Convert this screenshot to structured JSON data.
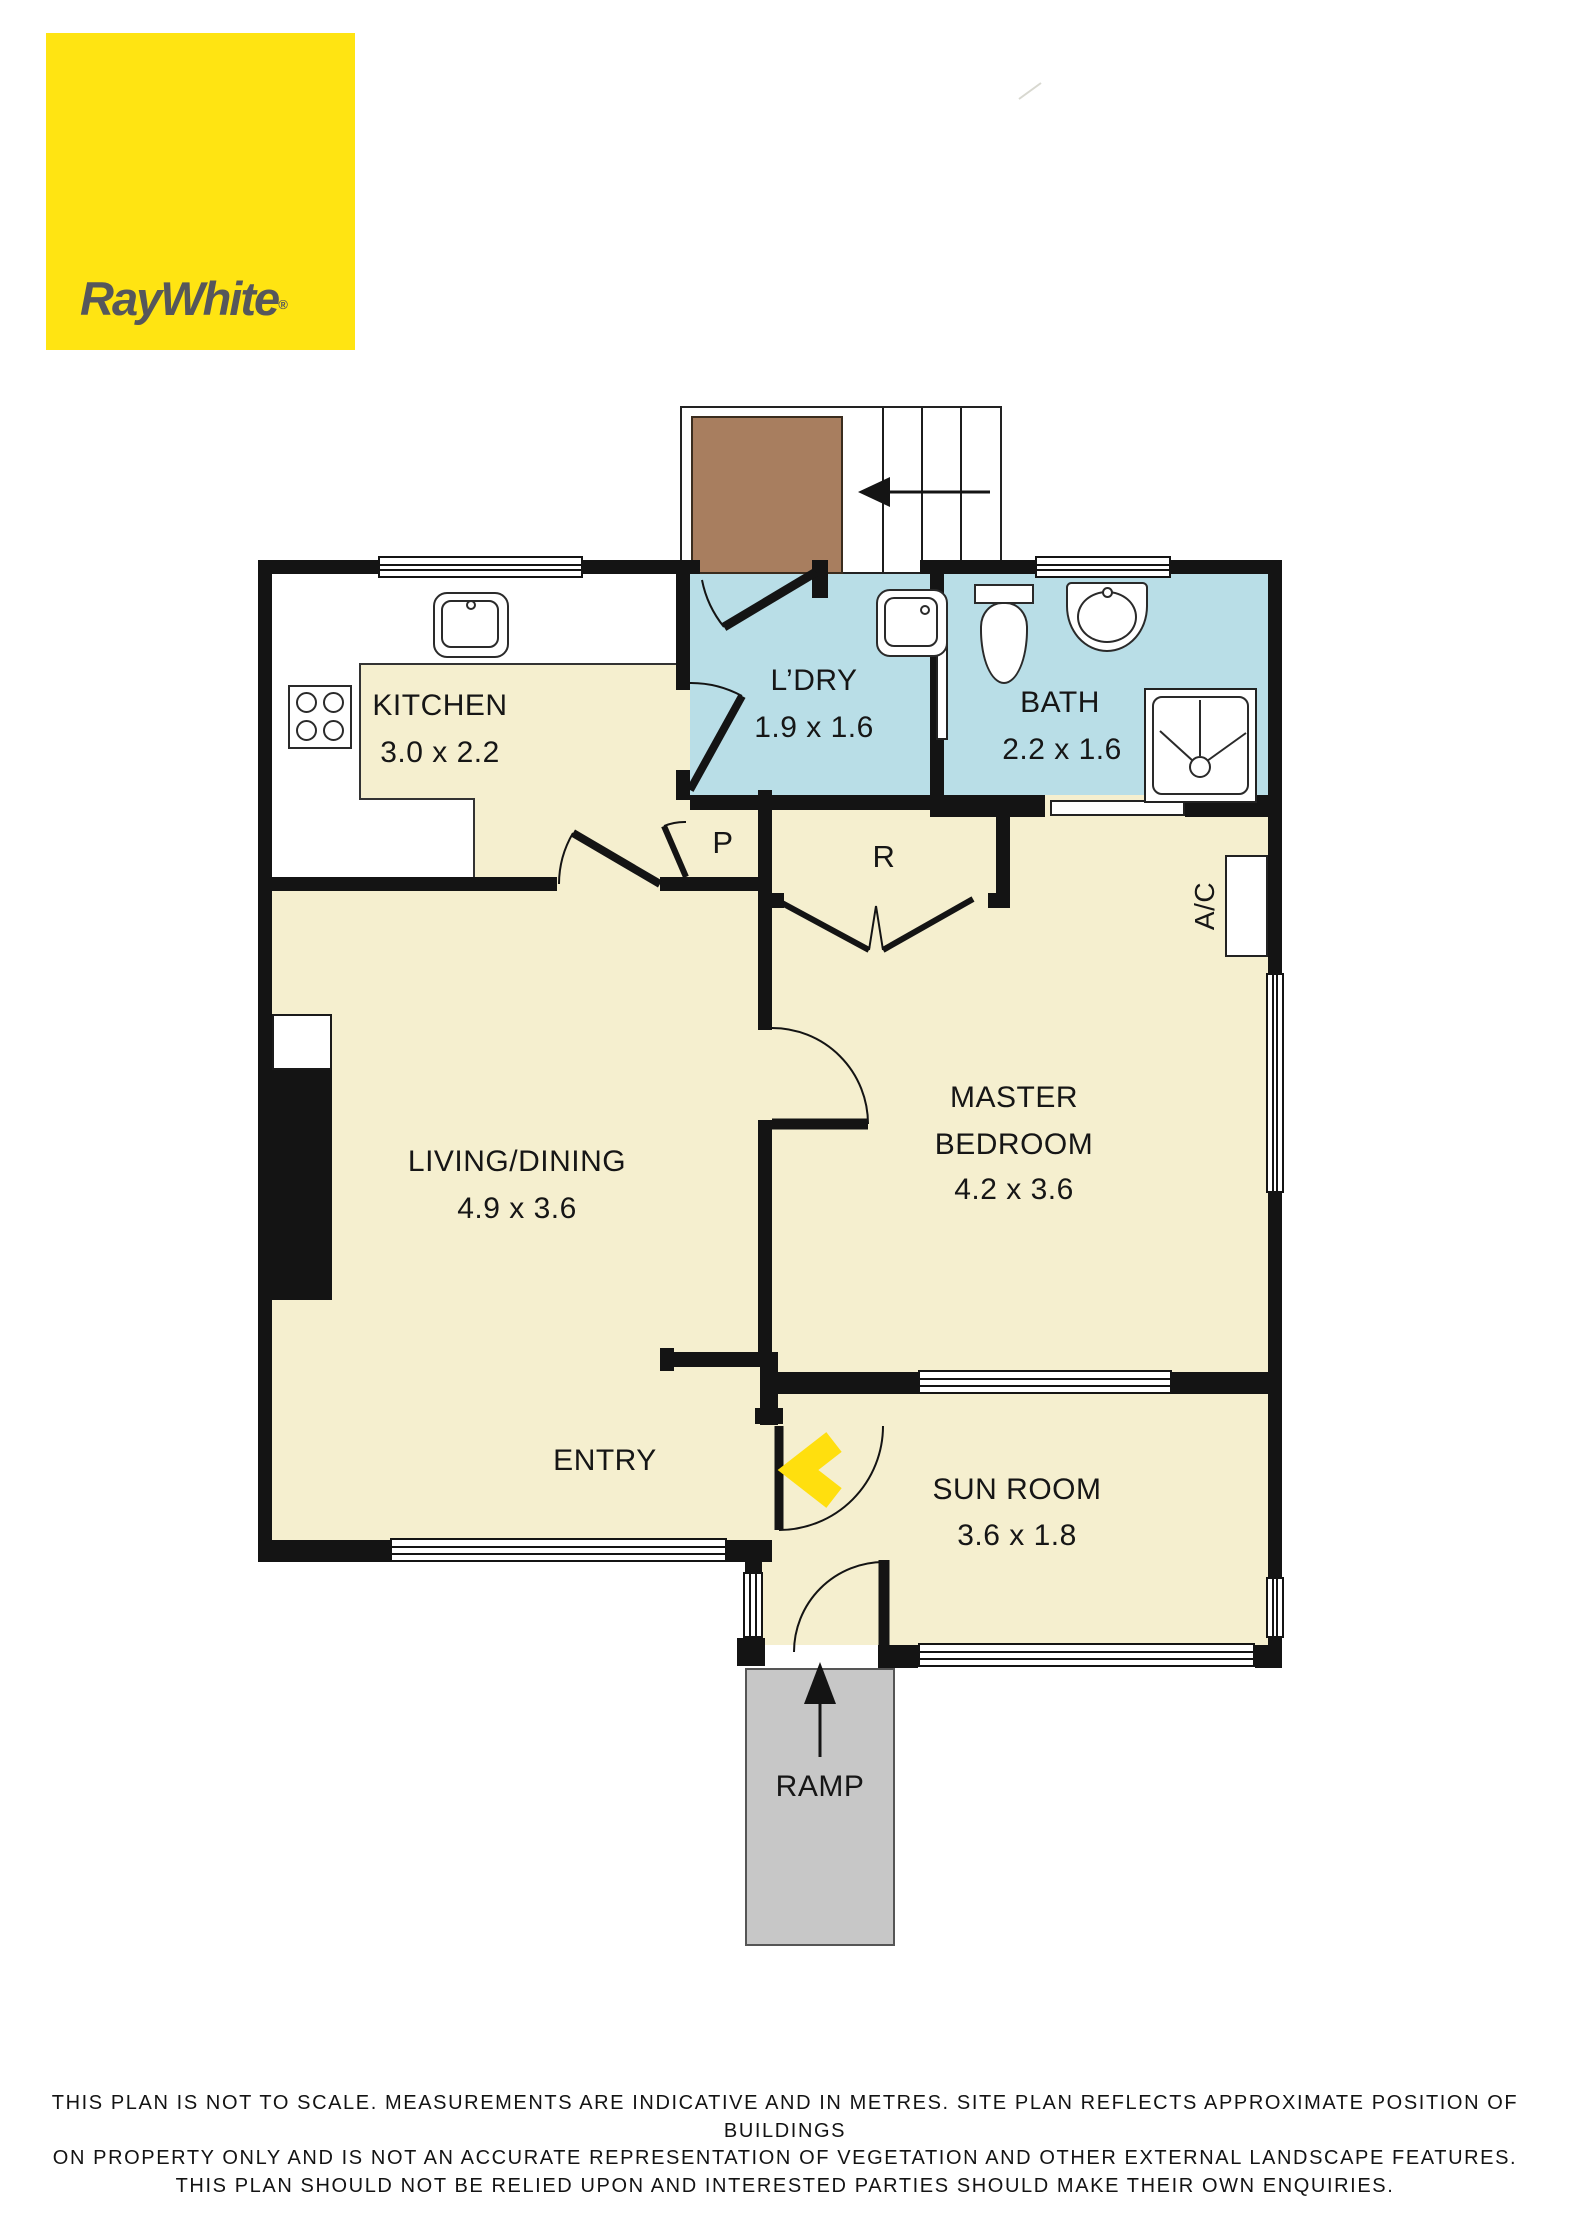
{
  "brand": {
    "logo_text": "RayWhite",
    "logo_mark": "®"
  },
  "plan": {
    "rooms": [
      {
        "name": "KITCHEN",
        "dims": "3.0 x 2.2"
      },
      {
        "name": "L’DRY",
        "dims": "1.9 x 1.6"
      },
      {
        "name": "BATH",
        "dims": "2.2 x 1.6"
      },
      {
        "name": "LIVING/DINING",
        "dims": "4.9 x 3.6"
      },
      {
        "name_line1": "MASTER",
        "name_line2": "BEDROOM",
        "dims": "4.2 x 3.6"
      },
      {
        "name": "SUN ROOM",
        "dims": "3.6 x 1.8"
      },
      {
        "name": "ENTRY"
      },
      {
        "name": "RAMP"
      }
    ],
    "markers": {
      "pantry": "P",
      "robe": "R",
      "air_conditioner": "A/C"
    }
  },
  "colors": {
    "brand_yellow": "#FFE412",
    "floor_cream": "#F5EFCF",
    "wet_area_blue": "#B9DEE7",
    "stair_landing_brown": "#A87E5F",
    "ramp_grey": "#C7C7C7",
    "wall_black": "#141414",
    "chevron_yellow": "#FFDF0E"
  },
  "icons": [
    "stairs",
    "stair-direction-arrow",
    "kitchen-sink",
    "stove",
    "laundry-tub",
    "toilet",
    "basin",
    "shower",
    "ac-unit",
    "ramp-arrow",
    "entry-chevron",
    "door-swing",
    "robe-bifold"
  ],
  "disclaimer": {
    "line1": "THIS PLAN IS NOT TO SCALE. MEASUREMENTS ARE INDICATIVE AND IN METRES. SITE PLAN REFLECTS APPROXIMATE POSITION OF BUILDINGS",
    "line2": "ON PROPERTY ONLY AND IS NOT AN ACCURATE REPRESENTATION OF VEGETATION AND OTHER EXTERNAL LANDSCAPE FEATURES.",
    "line3": "THIS PLAN SHOULD NOT BE RELIED UPON AND INTERESTED PARTIES SHOULD MAKE THEIR OWN ENQUIRIES."
  }
}
